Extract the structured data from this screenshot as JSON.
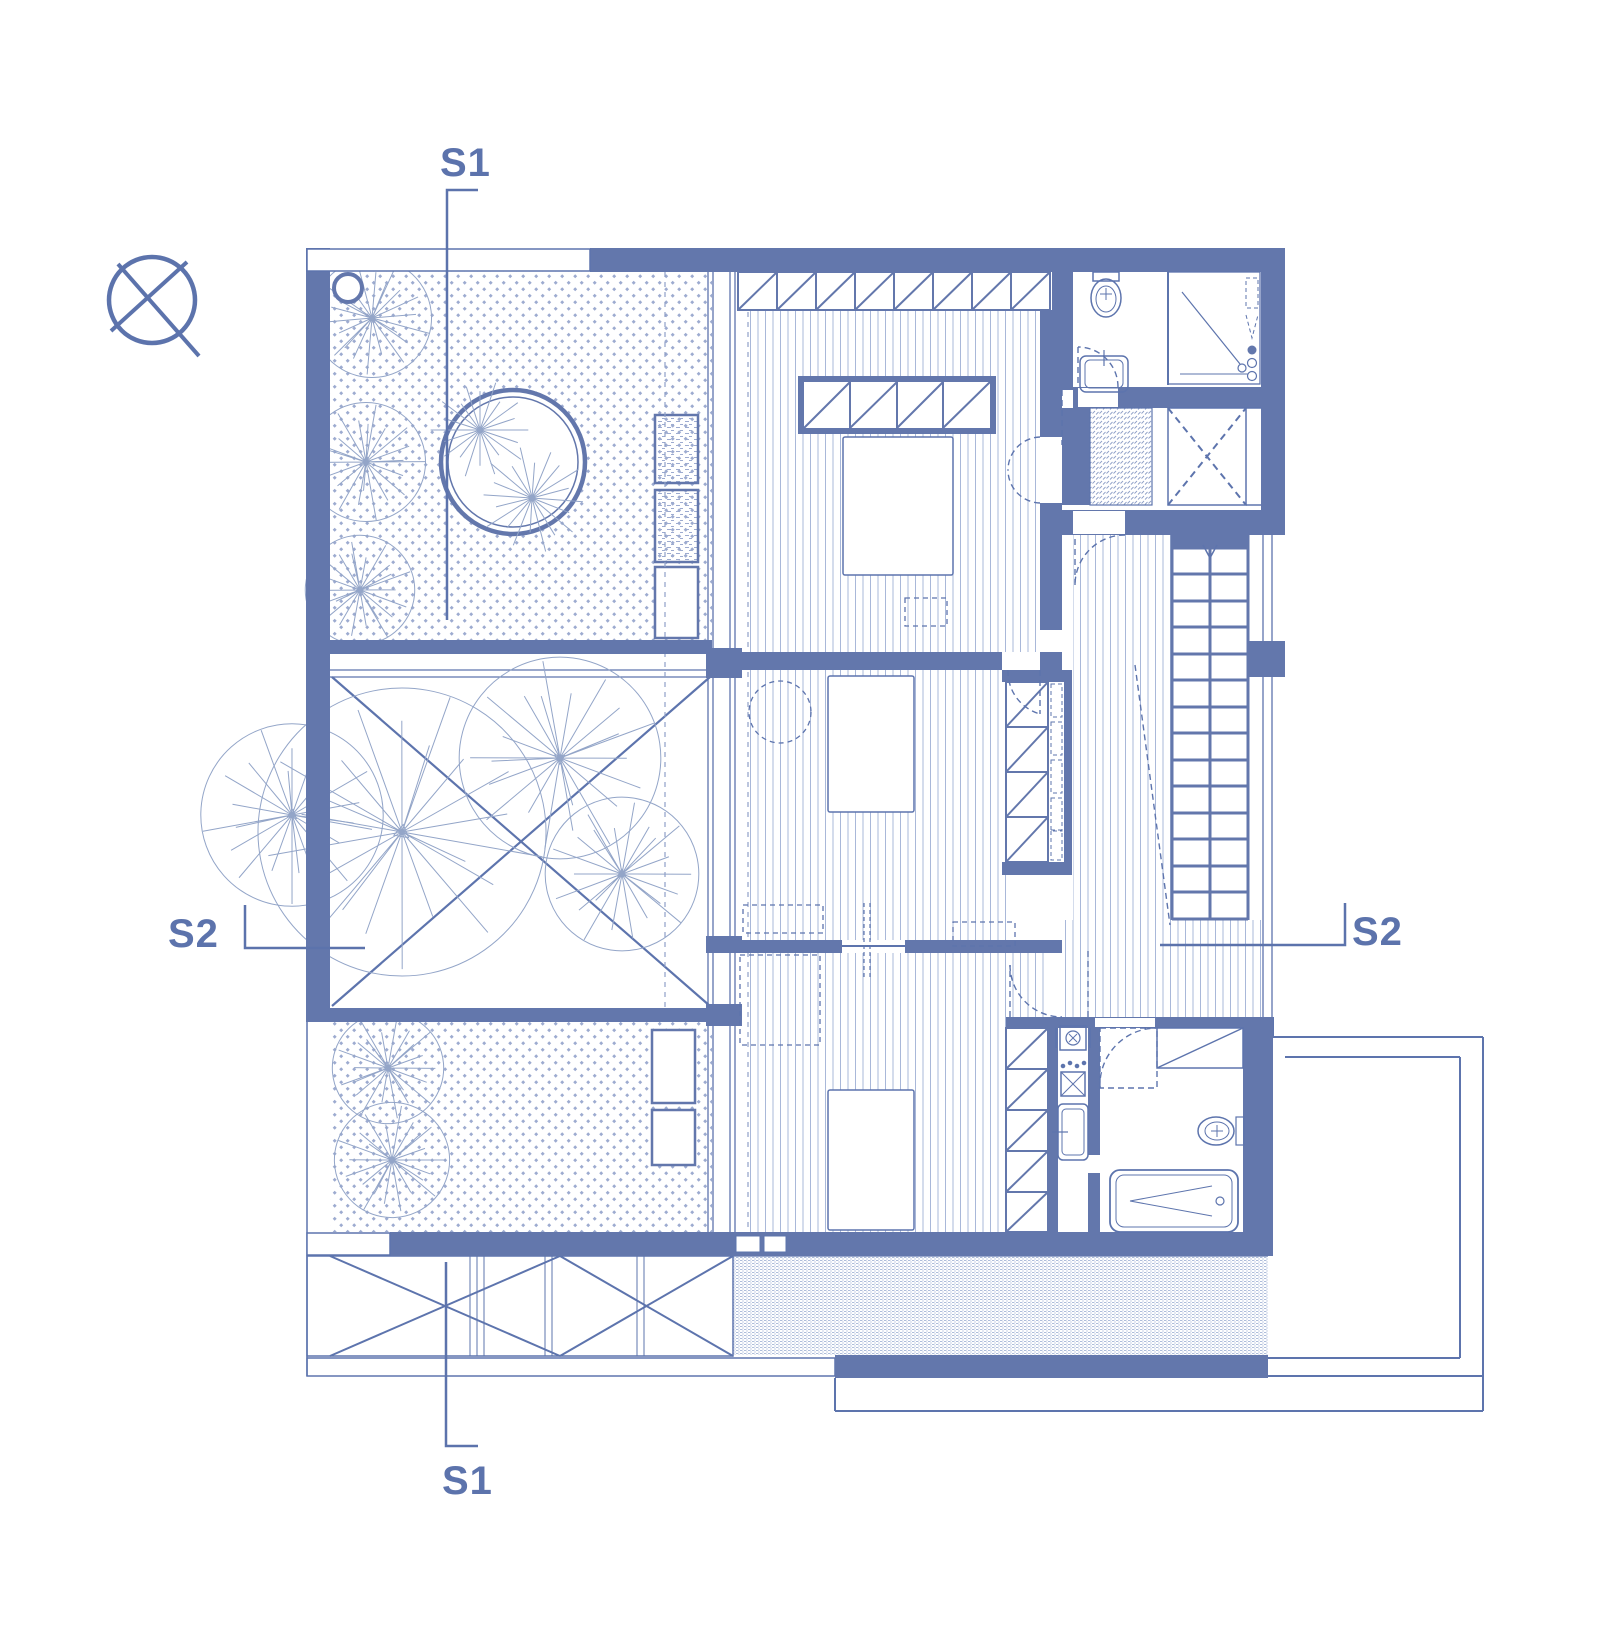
{
  "document": {
    "type": "architectural-floor-plan",
    "background": "#ffffff"
  },
  "colors": {
    "wall": "#6377ac",
    "line": "#5d74ad",
    "light_line": "#93a5c8",
    "hatch": "#9dabd0",
    "label_text": "#5c73ac"
  },
  "section_markers": {
    "s1_top": "S1",
    "s1_bottom": "S1",
    "s2_left": "S2",
    "s2_right": "S2"
  },
  "symbols": {
    "north_indicator": "north-indicator-icon"
  }
}
